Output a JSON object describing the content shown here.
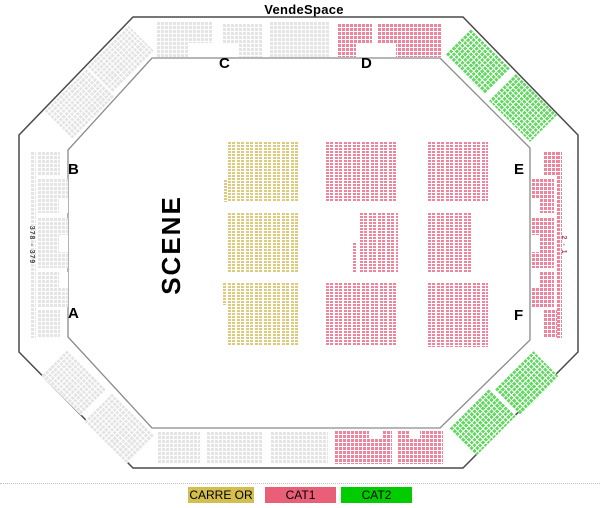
{
  "title": "VendeSpace",
  "stage": {
    "label": "SCENE"
  },
  "sections": {
    "a": "A",
    "b": "B",
    "c": "C",
    "d": "D",
    "e": "E",
    "f": "F"
  },
  "row_labels": {
    "left": "378 - 379",
    "right": "2 - 1"
  },
  "legend": {
    "items": [
      {
        "label": "CARRE OR",
        "color": "#d4bf4e"
      },
      {
        "label": "CAT1",
        "color": "#ea5f78"
      },
      {
        "label": "CAT2",
        "color": "#00cc00"
      }
    ]
  },
  "colors": {
    "carre_or": "#dccb7e",
    "cat1": "#f0849c",
    "cat2": "#62d762",
    "standard": "#e4e4e4",
    "outline_outer": "#4a4a4a",
    "outline_inner": "#8a8a8a"
  }
}
